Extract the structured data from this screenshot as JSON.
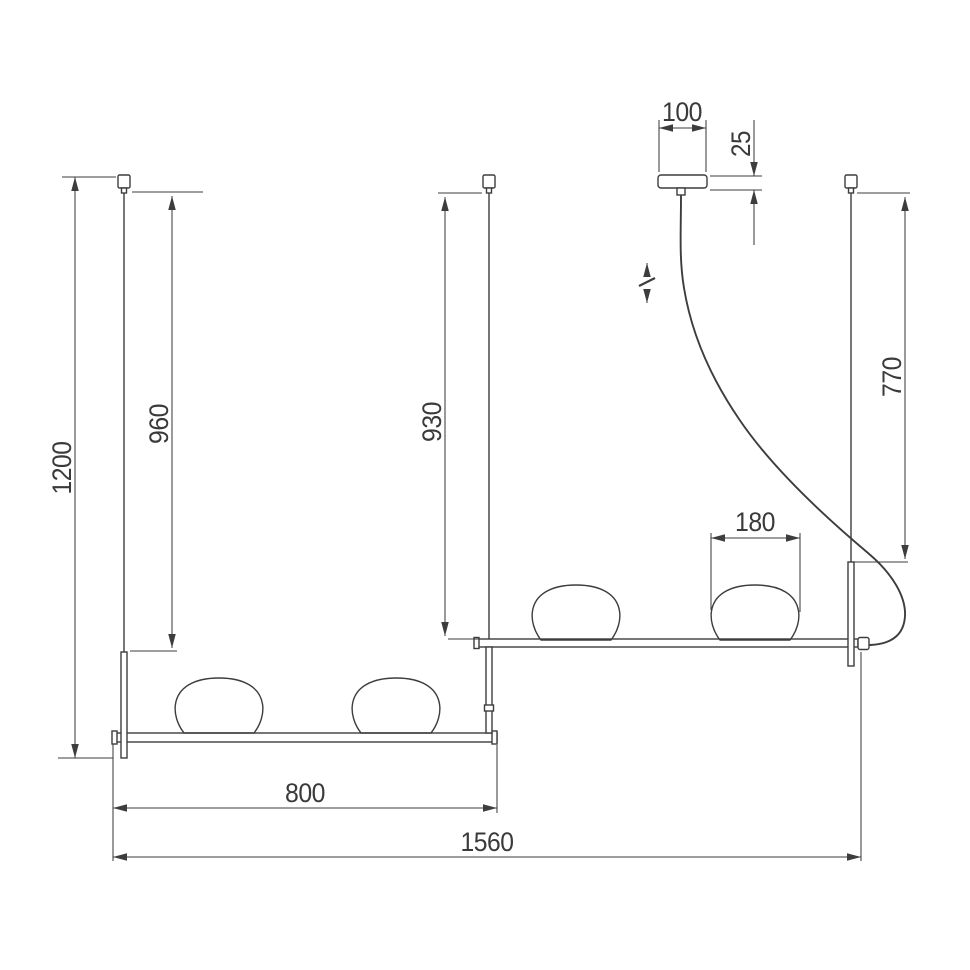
{
  "drawing": {
    "subject": "linear-pendant-light-dimension-drawing",
    "colors": {
      "line": "#3d3d3d",
      "text": "#3a3a3a",
      "background": "#ffffff"
    },
    "dimensions": {
      "overall_drop": "1200",
      "left_stem": "960",
      "center_stem": "930",
      "cord_drop": "770",
      "canopy_width": "100",
      "canopy_height": "25",
      "shade_width": "180",
      "lower_bar_span": "800",
      "overall_width": "1560"
    }
  }
}
